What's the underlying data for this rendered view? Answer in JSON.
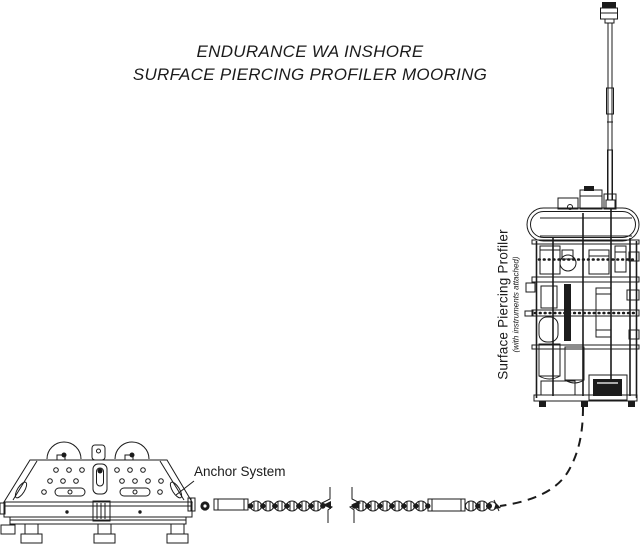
{
  "title": {
    "line1": "ENDURANCE WA INSHORE",
    "line2": "SURFACE PIERCING PROFILER MOORING"
  },
  "labels": {
    "profiler_title": "Surface Piercing Profiler",
    "profiler_subtitle": "(with instruments attached)",
    "anchor": "Anchor System"
  },
  "colors": {
    "ink": "#1b1b1b",
    "background": "#ffffff"
  }
}
